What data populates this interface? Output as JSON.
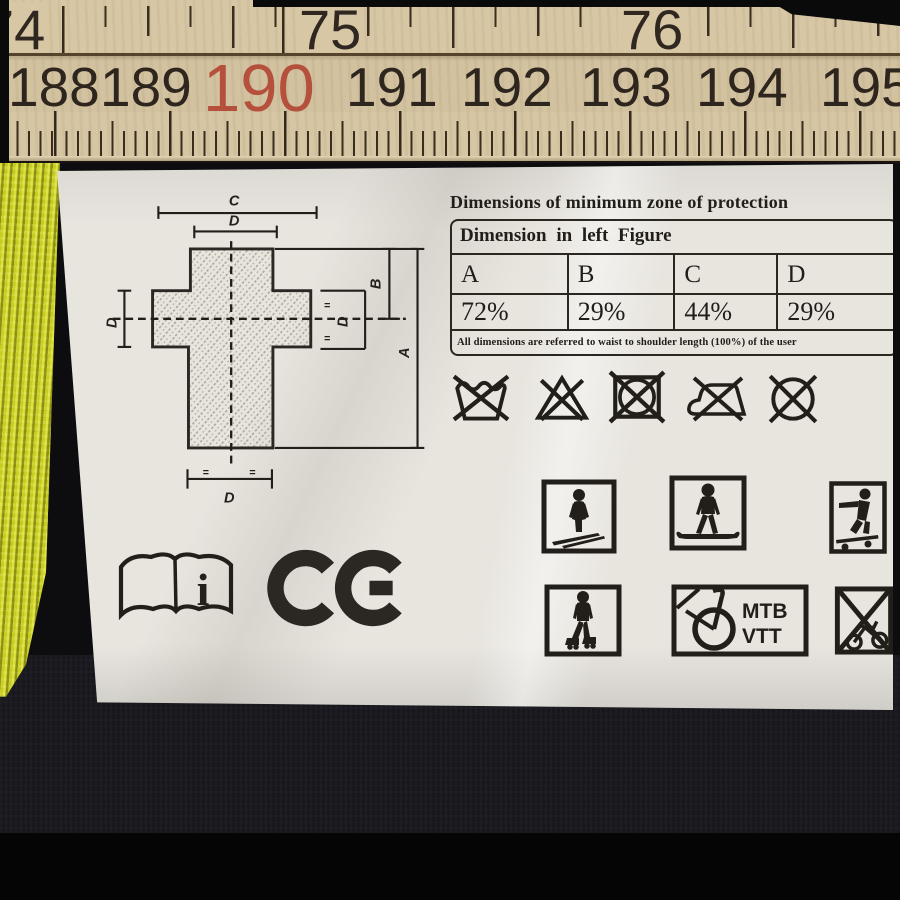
{
  "ruler": {
    "unit_top": [
      "74",
      "75",
      "76"
    ],
    "unit_bottom": [
      "188",
      "189",
      "190",
      "191",
      "192",
      "193",
      "194",
      "195"
    ],
    "highlighted_number": "190",
    "colors": {
      "wood": "#d6c6a4",
      "ink": "#2f2720",
      "highlight": "#b5503d"
    }
  },
  "label": {
    "title": "Dimensions of minimum zone of protection",
    "table": {
      "header": "Dimension in left Figure",
      "columns": [
        "A",
        "B",
        "C",
        "D"
      ],
      "values": [
        "72%",
        "29%",
        "44%",
        "29%"
      ],
      "footnote": "All dimensions are referred to waist to shoulder length (100%) of the user"
    },
    "diagram": {
      "labels": {
        "top": "C",
        "top_inner": "D",
        "left": "D",
        "right": "D",
        "b": "B",
        "a": "A",
        "bottom": "D",
        "equals": "="
      }
    },
    "care_symbols": [
      "do-not-wash",
      "do-not-bleach",
      "do-not-tumble-dry",
      "do-not-iron",
      "do-not-dry-clean"
    ],
    "pictograms": {
      "activities": [
        "skiing",
        "snowboarding",
        "skateboarding",
        "inline-skating",
        "mountain-biking",
        "no-cycling"
      ],
      "mtb_lines": [
        "MTB",
        "VTT"
      ]
    },
    "book_icon_letter": "i",
    "ce_mark": "CE"
  }
}
